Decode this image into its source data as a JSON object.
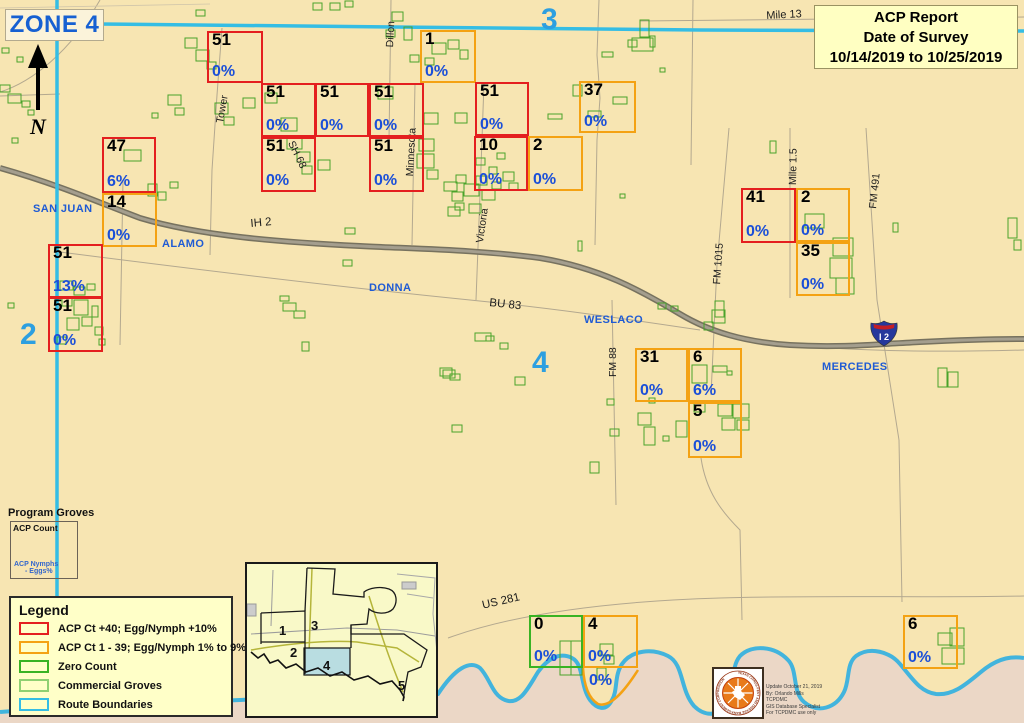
{
  "zone_title": "ZONE 4",
  "north_label": "N",
  "report_box": {
    "line1": "ACP Report",
    "line2": "Date of Survey",
    "line3": "10/14/2019 to 10/25/2019"
  },
  "program_groves": {
    "title": "Program Groves",
    "count_label": "ACP Count",
    "nymphs_label": "ACP  Nymphs",
    "eggs_label": "- Eggs%"
  },
  "legend": {
    "title": "Legend",
    "items": [
      {
        "label": "ACP Ct +40; Egg/Nymph +10%",
        "color": "#e41f1f"
      },
      {
        "label": "ACP Ct 1 - 39; Egg/Nymph 1% to 9%",
        "color": "#f4a213"
      },
      {
        "label": "Zero Count",
        "color": "#39b323"
      },
      {
        "label": "Commercial Groves",
        "color": "#8fd072"
      },
      {
        "label": "Route Boundaries",
        "color": "#35bde4"
      }
    ]
  },
  "inset": {
    "zones": [
      "1",
      "2",
      "3",
      "4",
      "5"
    ]
  },
  "interstate_shield": {
    "label": "I 2"
  },
  "logo_caption": {
    "lines": [
      "Update October 21, 2019",
      "By: Orlando Mills",
      "TCPDMC",
      "GIS Database Specialist",
      "For TCPDMC use only"
    ]
  },
  "seal": {
    "ring_text": "TEXAS CITRUS PEST AND DISEASE MANAGEMENT CORPORATION"
  },
  "colors": {
    "map_bg": "#f7e5b2",
    "red": "#e41f1f",
    "orange": "#f4a213",
    "green": "#39b323",
    "none": "transparent",
    "route_cyan": "#35bde4",
    "pct_blue": "#1b4fd8",
    "zone_blue": "#2d9fe0",
    "city_blue": "#1f5bd4",
    "grove_green": "#4aa32a",
    "mexico": "#ebd7c6"
  },
  "map": {
    "zone_markers": [
      {
        "label": "3",
        "x": 541,
        "y": 3
      },
      {
        "label": "2",
        "x": 20,
        "y": 318
      },
      {
        "label": "4",
        "x": 532,
        "y": 346
      }
    ],
    "city_labels": [
      {
        "text": "SAN JUAN",
        "x": 33,
        "y": 203
      },
      {
        "text": "ALAMO",
        "x": 162,
        "y": 238
      },
      {
        "text": "DONNA",
        "x": 369,
        "y": 282
      },
      {
        "text": "WESLACO",
        "x": 584,
        "y": 314
      },
      {
        "text": "MERCEDES",
        "x": 822,
        "y": 361
      }
    ],
    "road_labels": [
      {
        "text": "Mile 13",
        "x": 766,
        "y": 10,
        "rot": -3,
        "size": 11
      },
      {
        "text": "IH 2",
        "x": 250,
        "y": 218,
        "rot": -5,
        "size": 11.5
      },
      {
        "text": "BU 83",
        "x": 490,
        "y": 297,
        "rot": 6,
        "size": 11.5
      },
      {
        "text": "US 281",
        "x": 481,
        "y": 600,
        "rot": -13,
        "size": 11.5
      },
      {
        "text": "Tower",
        "x": 214,
        "y": 122,
        "rot": -80,
        "size": 10.5
      },
      {
        "text": "Dillon",
        "x": 384,
        "y": 47,
        "rot": -87,
        "size": 10.5
      },
      {
        "text": "SH 68",
        "x": 296,
        "y": 139,
        "rot": 64,
        "size": 10.5
      },
      {
        "text": "Minnesota",
        "x": 404,
        "y": 176,
        "rot": -87,
        "size": 10.5
      },
      {
        "text": "Victoria",
        "x": 474,
        "y": 242,
        "rot": -82,
        "size": 10.5
      },
      {
        "text": "FM 88",
        "x": 607,
        "y": 377,
        "rot": -90,
        "size": 10.5
      },
      {
        "text": "FM 1015",
        "x": 711,
        "y": 284,
        "rot": -86,
        "size": 10.5
      },
      {
        "text": "Mile 1.5",
        "x": 787,
        "y": 185,
        "rot": -89,
        "size": 10.5
      },
      {
        "text": "FM 491",
        "x": 867,
        "y": 208,
        "rot": -84,
        "size": 10.5
      }
    ],
    "survey_blocks": [
      {
        "count": "51",
        "pct": "0%",
        "cat": "red",
        "x": 207,
        "y": 31,
        "w": 56,
        "h": 52
      },
      {
        "count": "47",
        "pct": "6%",
        "cat": "red",
        "x": 102,
        "y": 137,
        "w": 54,
        "h": 56
      },
      {
        "count": "14",
        "pct": "0%",
        "cat": "orange",
        "x": 102,
        "y": 193,
        "w": 55,
        "h": 54
      },
      {
        "count": "51",
        "pct": "13%",
        "cat": "red",
        "x": 48,
        "y": 244,
        "w": 55,
        "h": 54
      },
      {
        "count": "51",
        "pct": "0%",
        "cat": "red",
        "x": 48,
        "y": 297,
        "w": 55,
        "h": 55
      },
      {
        "count": "51",
        "pct": "0%",
        "cat": "red",
        "x": 261,
        "y": 83,
        "w": 55,
        "h": 54
      },
      {
        "count": "51",
        "pct": "0%",
        "cat": "red",
        "x": 315,
        "y": 83,
        "w": 54,
        "h": 54
      },
      {
        "count": "51",
        "pct": "0%",
        "cat": "red",
        "x": 369,
        "y": 83,
        "w": 55,
        "h": 54
      },
      {
        "count": "51",
        "pct": "0%",
        "cat": "red",
        "x": 261,
        "y": 137,
        "w": 55,
        "h": 55
      },
      {
        "count": "51",
        "pct": "0%",
        "cat": "red",
        "x": 369,
        "y": 137,
        "w": 55,
        "h": 55
      },
      {
        "count": "1",
        "pct": "0%",
        "cat": "orange",
        "x": 420,
        "y": 30,
        "w": 56,
        "h": 53
      },
      {
        "count": "51",
        "pct": "0%",
        "cat": "red",
        "x": 475,
        "y": 82,
        "w": 54,
        "h": 54
      },
      {
        "count": "10",
        "pct": "0%",
        "cat": "red",
        "x": 474,
        "y": 136,
        "w": 54,
        "h": 55
      },
      {
        "count": "2",
        "pct": "0%",
        "cat": "orange",
        "x": 528,
        "y": 136,
        "w": 55,
        "h": 55
      },
      {
        "count": "37",
        "pct": "0%",
        "cat": "orange",
        "x": 579,
        "y": 81,
        "w": 57,
        "h": 52
      },
      {
        "count": "41",
        "pct": "0%",
        "cat": "red",
        "x": 741,
        "y": 188,
        "w": 55,
        "h": 55
      },
      {
        "count": "2",
        "pct": "0%",
        "cat": "orange",
        "x": 796,
        "y": 188,
        "w": 54,
        "h": 54
      },
      {
        "count": "35",
        "pct": "0%",
        "cat": "orange",
        "x": 796,
        "y": 242,
        "w": 54,
        "h": 54
      },
      {
        "count": "31",
        "pct": "0%",
        "cat": "orange",
        "x": 635,
        "y": 348,
        "w": 53,
        "h": 54
      },
      {
        "count": "6",
        "pct": "6%",
        "cat": "orange",
        "x": 688,
        "y": 348,
        "w": 54,
        "h": 54
      },
      {
        "count": "5",
        "pct": "0%",
        "cat": "orange",
        "x": 688,
        "y": 402,
        "w": 54,
        "h": 56
      },
      {
        "count": "0",
        "pct": "0%",
        "cat": "green",
        "x": 529,
        "y": 615,
        "w": 54,
        "h": 53
      },
      {
        "count": "4",
        "pct": "0%",
        "cat": "orange",
        "x": 583,
        "y": 615,
        "w": 55,
        "h": 53
      },
      {
        "count": "",
        "pct": "0%",
        "cat": "none",
        "x": 586,
        "y": 656,
        "w": 50,
        "h": 34
      },
      {
        "count": "6",
        "pct": "0%",
        "cat": "orange",
        "x": 903,
        "y": 615,
        "w": 55,
        "h": 54
      }
    ],
    "groves": [
      [
        185,
        38,
        12,
        10
      ],
      [
        196,
        50,
        13,
        11
      ],
      [
        207,
        62,
        9,
        7
      ],
      [
        196,
        10,
        9,
        6
      ],
      [
        168,
        95,
        13,
        10
      ],
      [
        175,
        108,
        9,
        7
      ],
      [
        152,
        113,
        6,
        5
      ],
      [
        215,
        103,
        13,
        11
      ],
      [
        224,
        117,
        10,
        8
      ],
      [
        243,
        98,
        12,
        10
      ],
      [
        0,
        85,
        10,
        7
      ],
      [
        8,
        94,
        13,
        9
      ],
      [
        22,
        101,
        8,
        6
      ],
      [
        2,
        48,
        7,
        5
      ],
      [
        17,
        57,
        6,
        5
      ],
      [
        28,
        110,
        6,
        5
      ],
      [
        12,
        138,
        6,
        5
      ],
      [
        8,
        303,
        6,
        5
      ],
      [
        124,
        150,
        17,
        11
      ],
      [
        148,
        184,
        9,
        12
      ],
      [
        158,
        192,
        8,
        8
      ],
      [
        170,
        182,
        8,
        6
      ],
      [
        60,
        281,
        13,
        9
      ],
      [
        74,
        287,
        11,
        8
      ],
      [
        87,
        284,
        8,
        6
      ],
      [
        62,
        298,
        10,
        8
      ],
      [
        74,
        300,
        14,
        15
      ],
      [
        67,
        318,
        12,
        12
      ],
      [
        82,
        317,
        10,
        9
      ],
      [
        92,
        306,
        6,
        11
      ],
      [
        95,
        327,
        8,
        8
      ],
      [
        57,
        337,
        9,
        7
      ],
      [
        99,
        339,
        6,
        6
      ],
      [
        265,
        93,
        12,
        10
      ],
      [
        281,
        118,
        16,
        13
      ],
      [
        287,
        138,
        15,
        11
      ],
      [
        297,
        152,
        13,
        10
      ],
      [
        302,
        166,
        10,
        8
      ],
      [
        318,
        160,
        12,
        10
      ],
      [
        378,
        87,
        15,
        12
      ],
      [
        424,
        113,
        14,
        11
      ],
      [
        455,
        113,
        12,
        10
      ],
      [
        419,
        139,
        15,
        12
      ],
      [
        417,
        154,
        17,
        14
      ],
      [
        427,
        170,
        11,
        9
      ],
      [
        313,
        3,
        9,
        7
      ],
      [
        330,
        3,
        10,
        7
      ],
      [
        345,
        1,
        8,
        6
      ],
      [
        392,
        12,
        11,
        9
      ],
      [
        404,
        27,
        8,
        13
      ],
      [
        386,
        30,
        9,
        7
      ],
      [
        432,
        43,
        14,
        11
      ],
      [
        448,
        40,
        11,
        9
      ],
      [
        460,
        50,
        8,
        9
      ],
      [
        410,
        55,
        9,
        7
      ],
      [
        425,
        58,
        9,
        7
      ],
      [
        444,
        182,
        13,
        9
      ],
      [
        456,
        175,
        10,
        8
      ],
      [
        452,
        192,
        11,
        9
      ],
      [
        464,
        184,
        15,
        12
      ],
      [
        476,
        176,
        11,
        9
      ],
      [
        482,
        190,
        13,
        10
      ],
      [
        492,
        182,
        9,
        7
      ],
      [
        489,
        167,
        8,
        7
      ],
      [
        476,
        158,
        9,
        7
      ],
      [
        497,
        153,
        8,
        6
      ],
      [
        503,
        172,
        11,
        9
      ],
      [
        455,
        203,
        9,
        7
      ],
      [
        469,
        204,
        12,
        9
      ],
      [
        509,
        183,
        9,
        7
      ],
      [
        448,
        207,
        12,
        9
      ],
      [
        573,
        85,
        9,
        11
      ],
      [
        613,
        97,
        14,
        7
      ],
      [
        588,
        111,
        13,
        6
      ],
      [
        548,
        114,
        14,
        5
      ],
      [
        602,
        52,
        11,
        5
      ],
      [
        640,
        20,
        9,
        17
      ],
      [
        632,
        38,
        21,
        13
      ],
      [
        650,
        36,
        5,
        11
      ],
      [
        628,
        40,
        9,
        7
      ],
      [
        660,
        68,
        5,
        4
      ],
      [
        345,
        228,
        10,
        6
      ],
      [
        343,
        260,
        9,
        6
      ],
      [
        283,
        303,
        13,
        8
      ],
      [
        294,
        311,
        11,
        7
      ],
      [
        280,
        296,
        9,
        5
      ],
      [
        302,
        342,
        7,
        9
      ],
      [
        475,
        333,
        16,
        8
      ],
      [
        443,
        370,
        12,
        8
      ],
      [
        515,
        377,
        10,
        8
      ],
      [
        486,
        336,
        8,
        5
      ],
      [
        500,
        343,
        8,
        6
      ],
      [
        452,
        425,
        10,
        7
      ],
      [
        578,
        241,
        4,
        10
      ],
      [
        620,
        194,
        5,
        4
      ],
      [
        658,
        303,
        8,
        6
      ],
      [
        671,
        306,
        7,
        5
      ],
      [
        770,
        141,
        6,
        12
      ],
      [
        805,
        214,
        19,
        14
      ],
      [
        833,
        238,
        20,
        18
      ],
      [
        830,
        258,
        22,
        20
      ],
      [
        836,
        278,
        18,
        16
      ],
      [
        893,
        223,
        5,
        9
      ],
      [
        1008,
        218,
        9,
        20
      ],
      [
        1014,
        240,
        7,
        10
      ],
      [
        712,
        310,
        13,
        13
      ],
      [
        704,
        322,
        9,
        8
      ],
      [
        715,
        301,
        9,
        16
      ],
      [
        692,
        365,
        15,
        18
      ],
      [
        713,
        366,
        14,
        6
      ],
      [
        727,
        371,
        5,
        4
      ],
      [
        694,
        403,
        11,
        9
      ],
      [
        718,
        404,
        14,
        12
      ],
      [
        733,
        404,
        16,
        14
      ],
      [
        722,
        418,
        13,
        12
      ],
      [
        737,
        420,
        12,
        10
      ],
      [
        676,
        421,
        11,
        16
      ],
      [
        638,
        413,
        13,
        12
      ],
      [
        644,
        427,
        11,
        18
      ],
      [
        610,
        429,
        9,
        7
      ],
      [
        590,
        462,
        9,
        11
      ],
      [
        663,
        436,
        6,
        5
      ],
      [
        607,
        399,
        7,
        6
      ],
      [
        649,
        398,
        6,
        5
      ],
      [
        938,
        368,
        9,
        19
      ],
      [
        948,
        372,
        10,
        15
      ],
      [
        560,
        641,
        11,
        34
      ],
      [
        571,
        641,
        11,
        34
      ],
      [
        600,
        644,
        13,
        11
      ],
      [
        604,
        656,
        10,
        8
      ],
      [
        597,
        668,
        9,
        12
      ],
      [
        938,
        633,
        14,
        12
      ],
      [
        950,
        628,
        14,
        18
      ],
      [
        942,
        648,
        22,
        16
      ],
      [
        440,
        368,
        12,
        8
      ],
      [
        450,
        374,
        10,
        6
      ]
    ]
  }
}
